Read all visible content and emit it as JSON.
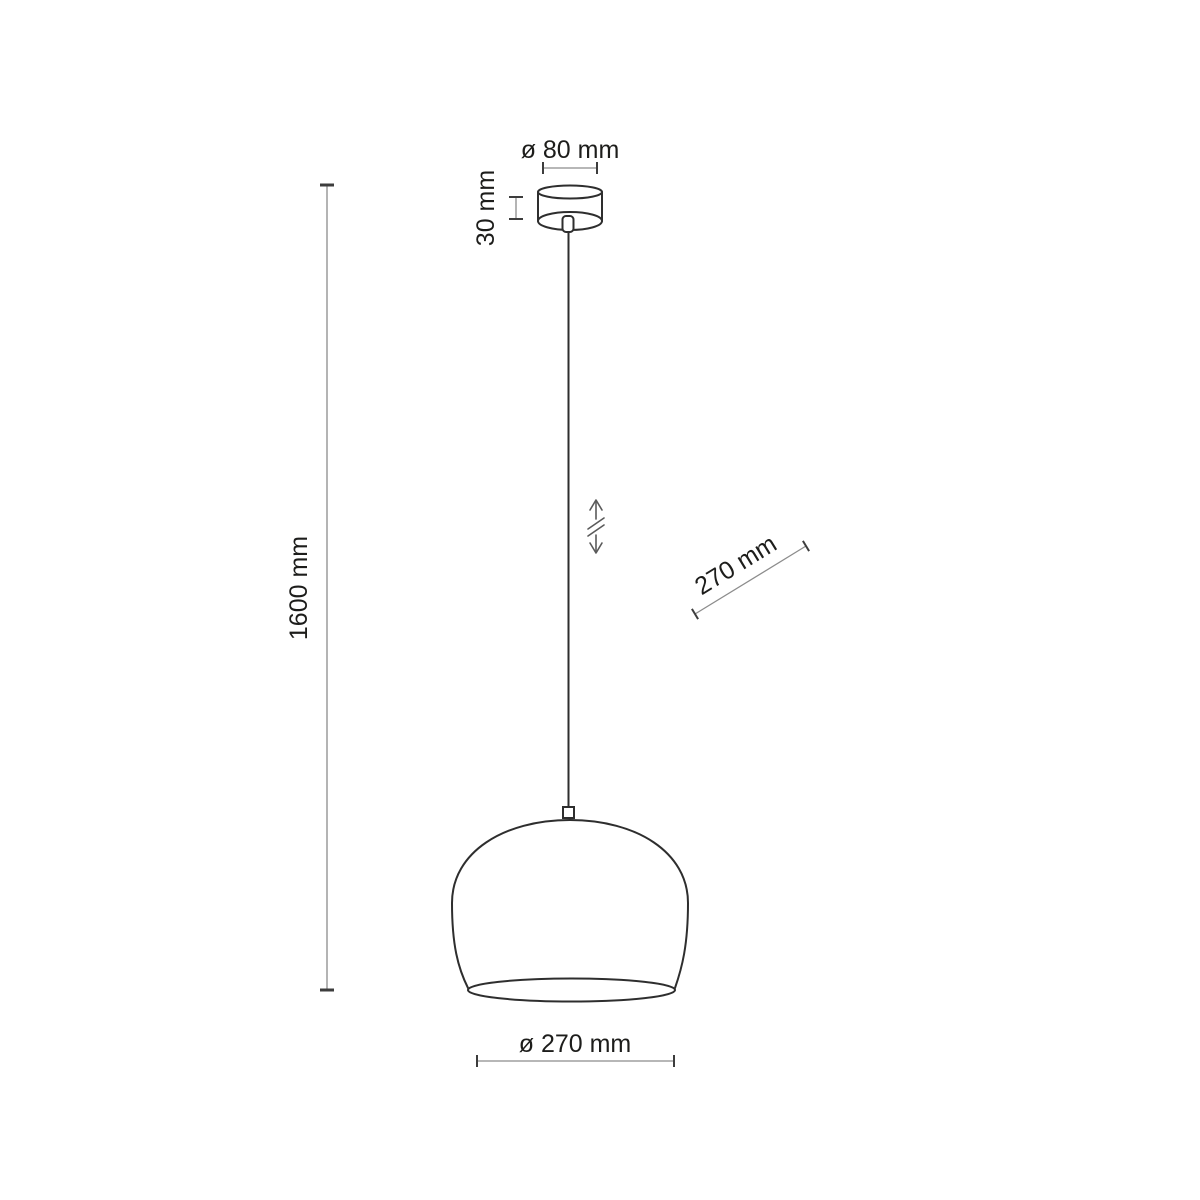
{
  "diagram": {
    "type": "pendant-lamp-dimension-drawing",
    "labels": {
      "canopy_diameter": "ø 80 mm",
      "canopy_height": "30 mm",
      "suspension_height": "1600 mm",
      "shade_depth": "270 mm",
      "shade_diameter": "ø 270 mm"
    },
    "colors": {
      "background": "#ffffff",
      "outline": "#2e2e2e",
      "dimension_line": "#8c8c8c",
      "dimension_tick": "#3d3d3d",
      "text": "#1d1d1b",
      "adjust_symbol": "#5a5a5a"
    }
  }
}
